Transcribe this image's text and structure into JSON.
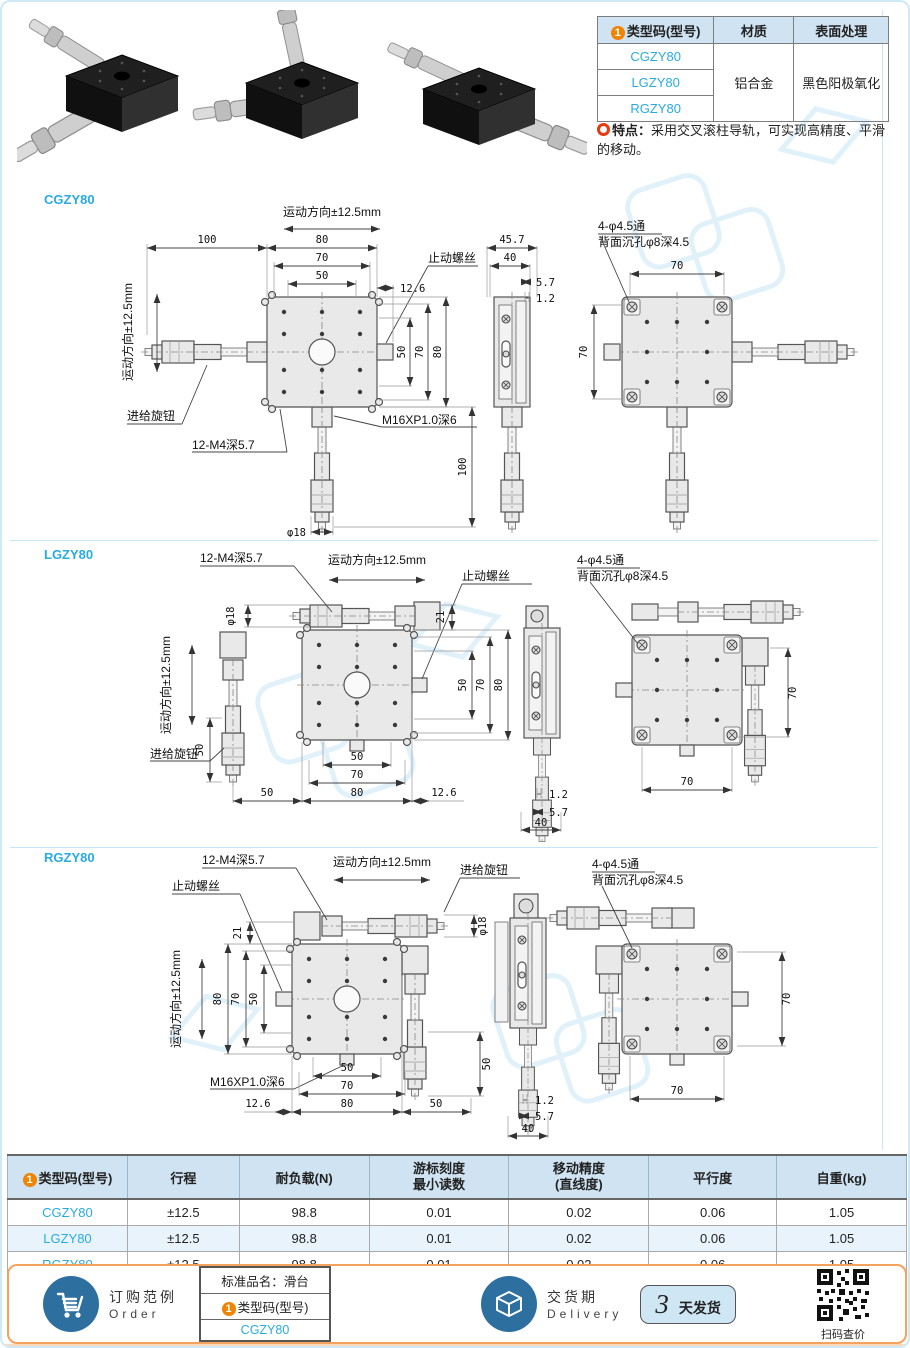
{
  "colors": {
    "accent_cyan": "#29abe2",
    "badge_orange": "#f08300",
    "feature_red": "#e8380d",
    "table_header_bg": "#cfe3f2",
    "row_alt_bg": "#e8f3fb",
    "divider_blue": "#c5e6f5",
    "footer_border_orange": "#f5a25c",
    "icon_circle_blue": "#2d6f9f"
  },
  "header": {
    "models_table": {
      "badge": "1",
      "col_model": "类型码(型号)",
      "col_material": "材质",
      "col_finish": "表面处理",
      "models": [
        "CGZY80",
        "LGZY80",
        "RGZY80"
      ],
      "material": "铝合金",
      "finish": "黑色阳极氧化"
    },
    "feature": {
      "label": "特点：",
      "text": "采用交叉滚柱导轨，可实现高精度、平滑的移动。"
    }
  },
  "sections": [
    {
      "model": "CGZY80",
      "labels": {
        "motion_h": "运动方向±12.5mm",
        "motion_v": "运动方向±12.5mm",
        "stop_screw": "止动螺丝",
        "feed_knob": "进给旋钮",
        "thread12": "12-M4深5.7",
        "m16": "M16XP1.0深6",
        "holes": "4-φ4.5通",
        "cbore": "背面沉孔φ8深4.5",
        "w100": "100",
        "w80": "80",
        "w70": "70",
        "w50": "50",
        "off126": "12.6",
        "h50": "50",
        "h70": "70",
        "h80": "80",
        "mic100": "100",
        "dia18": "φ18",
        "sv457": "45.7",
        "sv40": "40",
        "sv57": "5.7",
        "sv12": "1.2",
        "rv70h": "70",
        "rv70v": "70"
      }
    },
    {
      "model": "LGZY80",
      "labels": {
        "motion_h": "运动方向±12.5mm",
        "motion_v": "运动方向±12.5mm",
        "stop_screw": "止动螺丝",
        "feed_knob": "进给旋钮",
        "thread12": "12-M4深5.7",
        "holes": "4-φ4.5通",
        "cbore": "背面沉孔φ8深4.5",
        "dia18": "φ18",
        "t21": "21",
        "h50": "50",
        "h70": "70",
        "h80": "80",
        "left50": "50",
        "bottom50": "50",
        "b50": "50",
        "b70": "70",
        "b80": "80",
        "off126": "12.6",
        "sv12": "1.2",
        "sv57": "5.7",
        "sv40": "40",
        "rv70v": "70",
        "rv70b": "70"
      }
    },
    {
      "model": "RGZY80",
      "labels": {
        "motion_h": "运动方向±12.5mm",
        "motion_v": "运动方向±12.5mm",
        "stop_screw": "止动螺丝",
        "feed_knob": "进给旋钮",
        "thread12": "12-M4深5.7",
        "m16": "M16XP1.0深6",
        "holes": "4-φ4.5通",
        "cbore": "背面沉孔φ8深4.5",
        "t21": "21",
        "dia18": "φ18",
        "h80": "80",
        "h70": "70",
        "h50": "50",
        "b50": "50",
        "b70": "70",
        "b80": "80",
        "off126": "12.6",
        "right50": "50",
        "mic50": "50",
        "sv12": "1.2",
        "sv57": "5.7",
        "sv40": "40",
        "rv70v": "70",
        "rv70b": "70"
      }
    }
  ],
  "spec_table": {
    "badge": "1",
    "col_model": "类型码(型号)",
    "col_stroke": "行程",
    "col_load": "耐负载(N)",
    "col_vernier_1": "游标刻度",
    "col_vernier_2": "最小读数",
    "col_accuracy_1": "移动精度",
    "col_accuracy_2": "(直线度)",
    "col_parallel": "平行度",
    "col_weight": "自重(kg)",
    "rows": [
      {
        "model": "CGZY80",
        "stroke": "±12.5",
        "load": "98.8",
        "vernier": "0.01",
        "accuracy": "0.02",
        "parallelism": "0.06",
        "weight": "1.05"
      },
      {
        "model": "LGZY80",
        "stroke": "±12.5",
        "load": "98.8",
        "vernier": "0.01",
        "accuracy": "0.02",
        "parallelism": "0.06",
        "weight": "1.05"
      },
      {
        "model": "RGZY80",
        "stroke": "±12.5",
        "load": "98.8",
        "vernier": "0.01",
        "accuracy": "0.02",
        "parallelism": "0.06",
        "weight": "1.05"
      }
    ]
  },
  "footer": {
    "order": {
      "title": "订购范例",
      "subtitle": "Order",
      "box_line1": "标准品名：滑台",
      "box_badge": "1",
      "box_line2": "类型码(型号)",
      "box_value": "CGZY80"
    },
    "delivery": {
      "title": "交货期",
      "subtitle": "Delivery",
      "days": "3",
      "unit": "天发货",
      "qr_caption": "扫码查价"
    }
  }
}
